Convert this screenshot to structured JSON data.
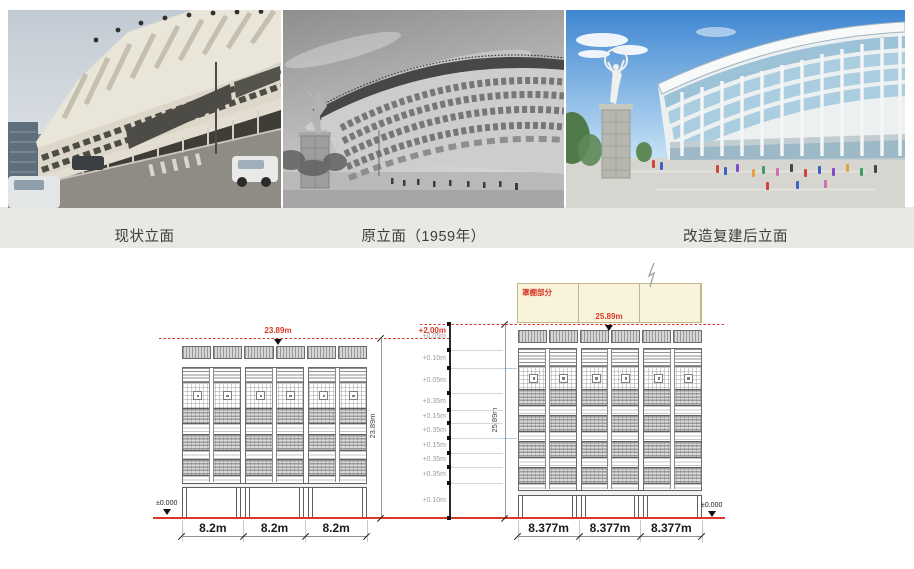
{
  "photo_strip": {
    "captions": [
      "现状立面",
      "原立面（1959年）",
      "改造复建后立面"
    ]
  },
  "drawing": {
    "level_offset": "+2.00m",
    "elevation_steps": [
      "+0.05m",
      "+0.10m",
      "+0.05m",
      "+0.35m",
      "+0.15m",
      "+0.35m",
      "+0.15m",
      "+0.35m",
      "+0.35m",
      "+0.10m"
    ],
    "left_elevation": {
      "peak_level": "23.89m",
      "overall_height": "23.89m",
      "ground_level": "±0.000",
      "bay_widths": [
        "8.2m",
        "8.2m",
        "8.2m"
      ]
    },
    "right_elevation": {
      "peak_level": "25.89m",
      "overall_height": "25.89m",
      "ground_level": "±0.000",
      "canopy_label": "罩棚部分",
      "bay_widths": [
        "8.377m",
        "8.377m",
        "8.377m"
      ]
    },
    "colors": {
      "accent_red": "#d93a28",
      "canopy_fill": "#f8f3db",
      "guide_blue": "#aecde6"
    }
  }
}
